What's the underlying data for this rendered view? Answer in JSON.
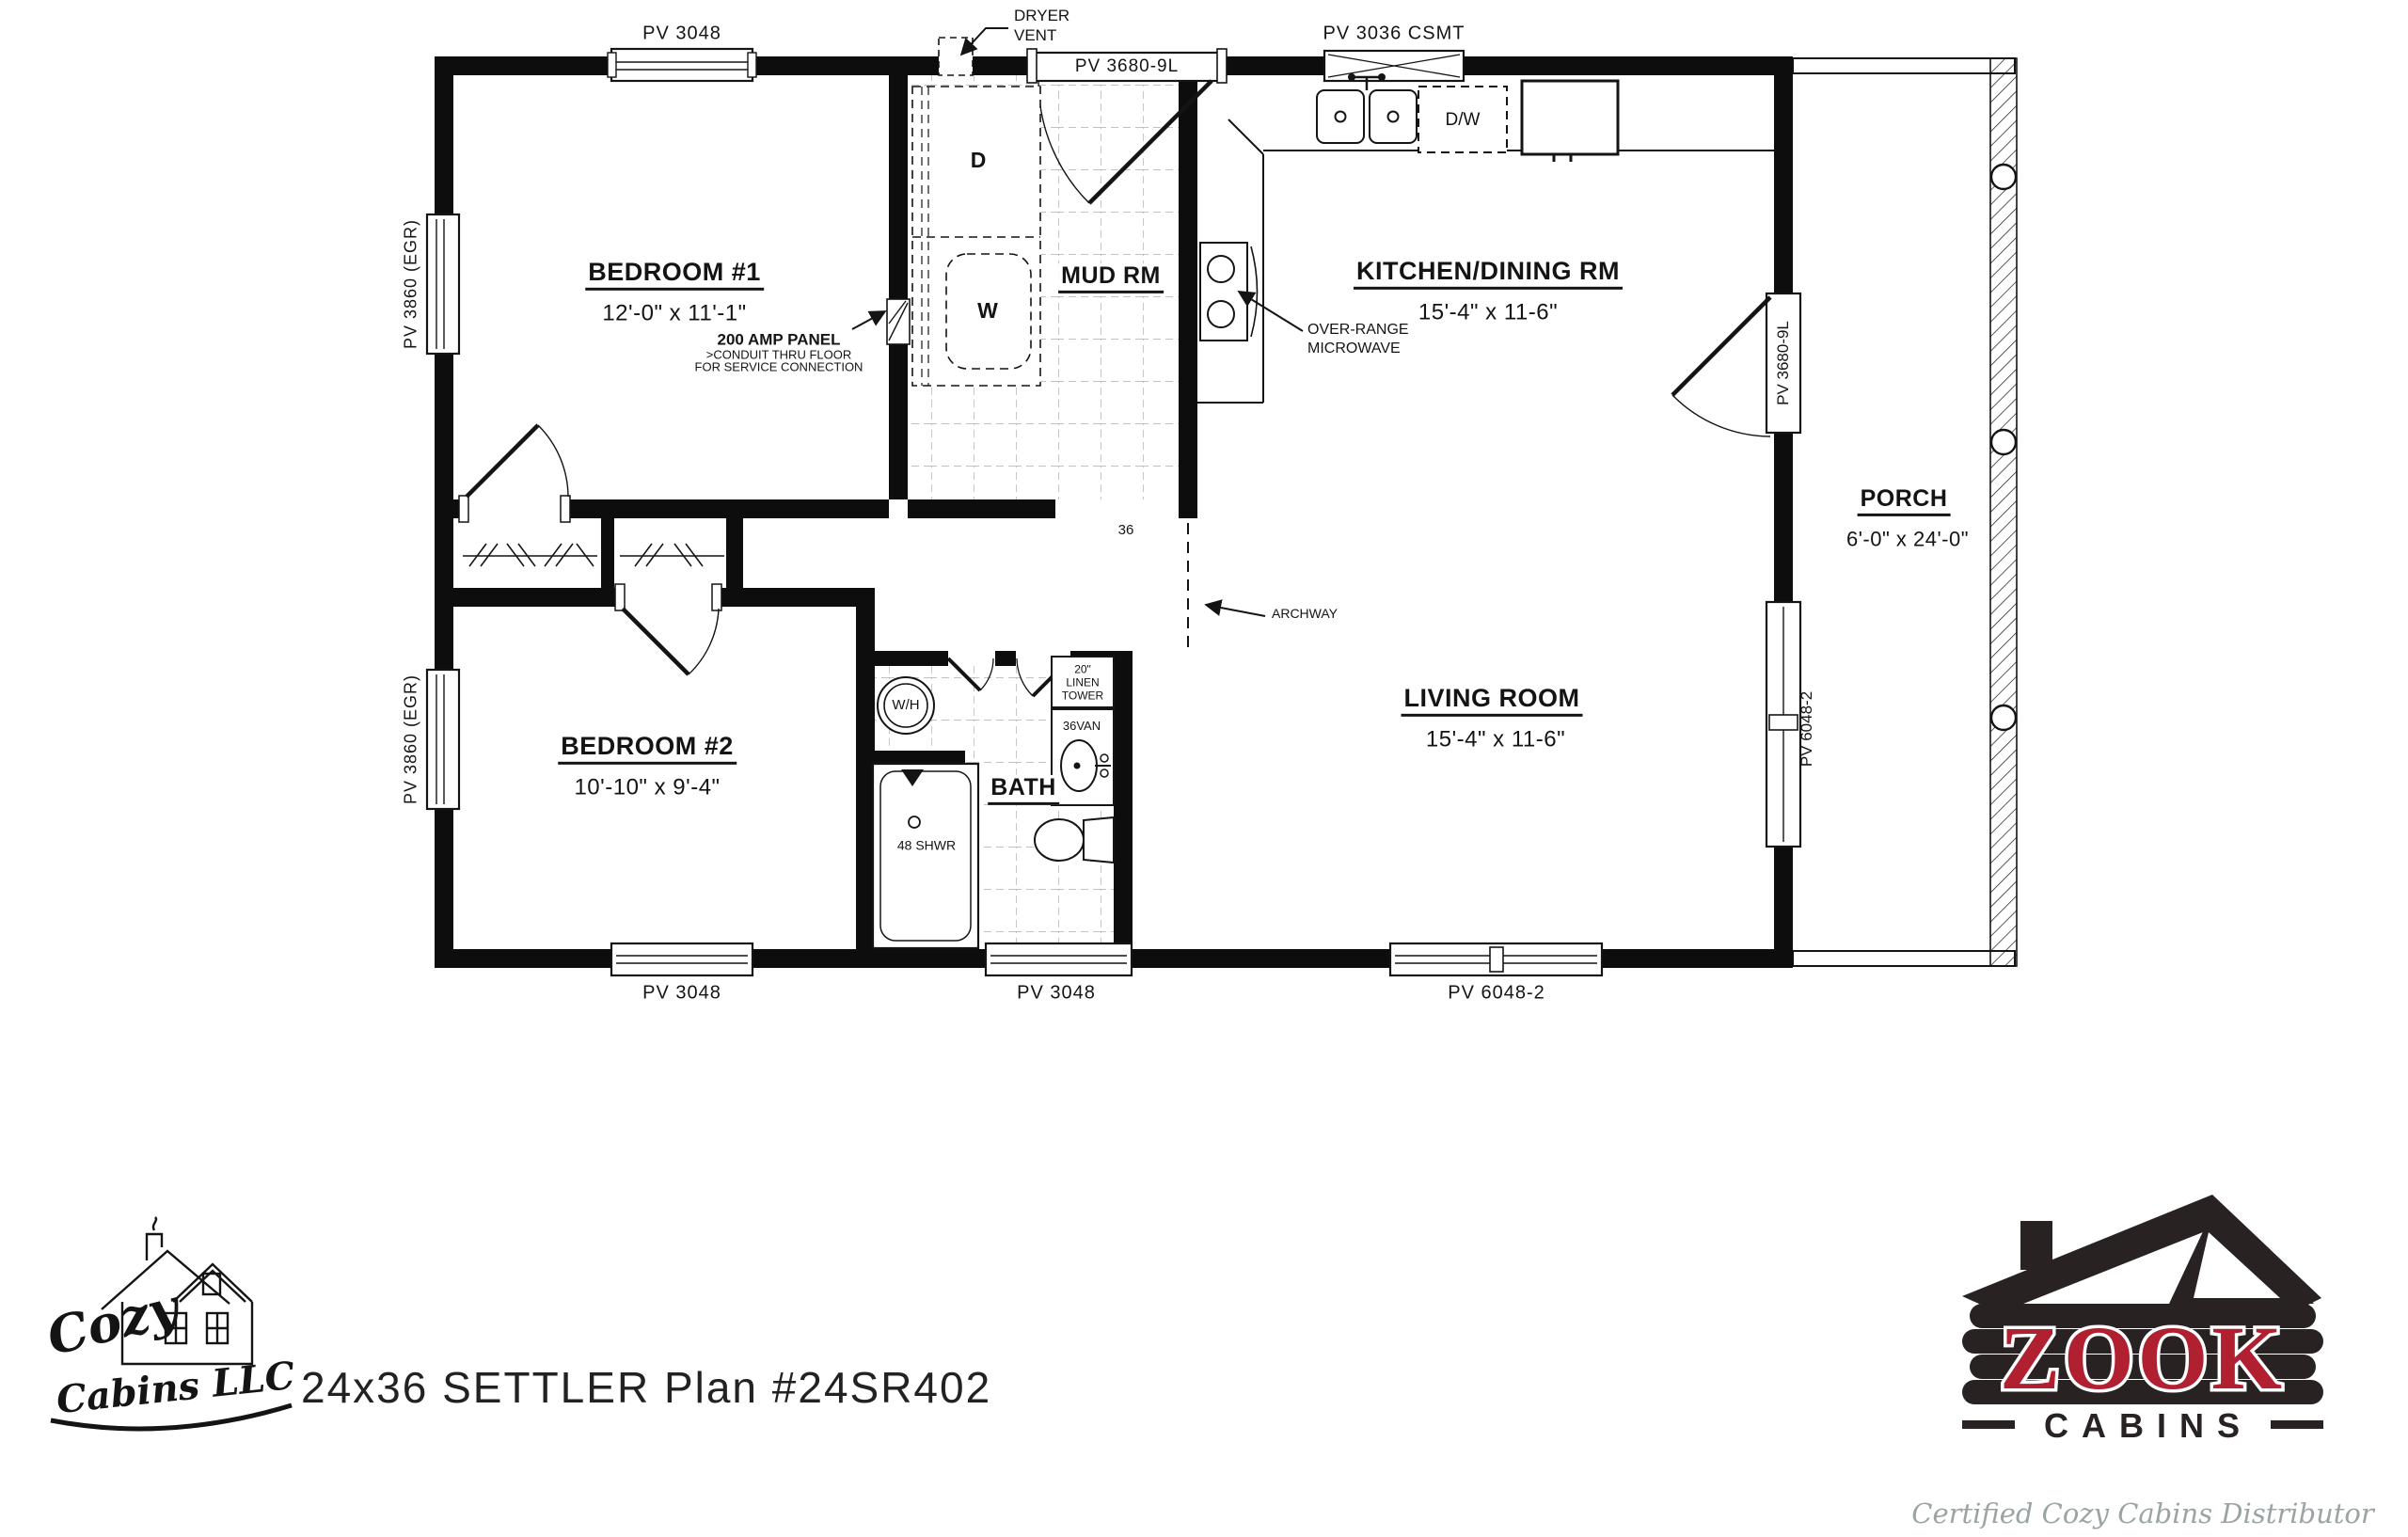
{
  "page": {
    "title": "24x36 SETTLER  Plan #24SR402"
  },
  "rooms": {
    "bedroom1": {
      "name": "BEDROOM #1",
      "dims": "12'-0\" x 11'-1\""
    },
    "bedroom2": {
      "name": "BEDROOM #2",
      "dims": "10'-10\" x 9'-4\""
    },
    "kitchen": {
      "name": "KITCHEN/DINING RM",
      "dims": "15'-4\" x 11-6\""
    },
    "living": {
      "name": "LIVING ROOM",
      "dims": "15'-4\" x 11-6\""
    },
    "mudroom": {
      "name": "MUD RM"
    },
    "bath": {
      "name": "BATH"
    },
    "porch": {
      "name": "PORCH",
      "dims": "6'-0\" x 24'-0\""
    }
  },
  "openings": {
    "top_window": "PV 3048",
    "mud_door": "PV 3680-9L",
    "kitchen_window": "PV 3036 CSMT",
    "left_window_top": "PV 3860 (EGR)",
    "left_window_bottom": "PV 3860 (EGR)",
    "bottom_window_bed2": "PV 3048",
    "bottom_window_bath": "PV 3048",
    "bottom_window_living": "PV 6048-2",
    "right_door": "PV 3680-9L",
    "right_window": "PV 6048-2",
    "hall_opening": "36"
  },
  "fixtures": {
    "dryer": "D",
    "washer": "W",
    "dishwasher": "D/W",
    "water_heater": "W/H",
    "linen_line1": "20\"",
    "linen_line2": "LINEN",
    "linen_line3": "TOWER",
    "vanity": "36VAN",
    "shower": "48 SHWR"
  },
  "annotations": {
    "dryer_vent_line1": "DRYER",
    "dryer_vent_line2": "VENT",
    "panel_line1": "200 AMP PANEL",
    "panel_line2": ">CONDUIT THRU FLOOR",
    "panel_line3": "FOR SERVICE CONNECTION",
    "microwave_line1": "OVER-RANGE",
    "microwave_line2": "MICROWAVE",
    "archway": "ARCHWAY"
  },
  "branding": {
    "cozy_logo_line1": "Cozy",
    "cozy_logo_line2": "Cabins LLC",
    "zook_name": "ZOOK",
    "zook_sub": "CABINS",
    "zook_tagline": "Certified Cozy Cabins Distributor",
    "colors": {
      "zook_red": "#b02030",
      "zook_dark": "#282223",
      "tagline_gray": "#9ba4a4"
    }
  }
}
